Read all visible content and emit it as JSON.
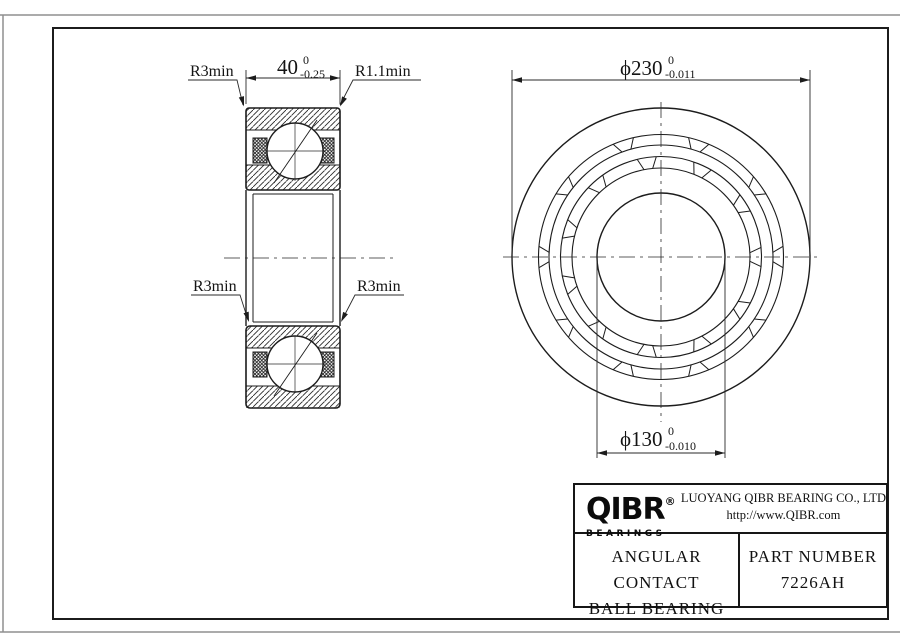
{
  "drawing_labels": {
    "dim_width": {
      "value": "40",
      "tol_upper": "0",
      "tol_lower": "-0.25"
    },
    "dim_od": {
      "value": "ϕ230",
      "tol_upper": "0",
      "tol_lower": "-0.011"
    },
    "dim_bore": {
      "value": "ϕ130",
      "tol_upper": "0",
      "tol_lower": "-0.010"
    },
    "r_top_left": "R3min",
    "r_top_right": "R1.1min",
    "r_mid_left": "R3min",
    "r_mid_right": "R3min"
  },
  "title_block": {
    "logo_text": "QIBR",
    "logo_registered": "®",
    "logo_subtext": "BEARINGS",
    "company_name": "LUOYANG QIBR BEARING CO., LTD",
    "website": "http://www.QIBR.com",
    "product_line1": "ANGULAR CONTACT",
    "product_line2": "BALL BEARING",
    "part_number_label": "PART NUMBER",
    "part_number": "7226AH"
  },
  "colors": {
    "line": "#1c1c1c",
    "thin_line": "#2a2a2a",
    "frame_outer": "#8f8f8f",
    "background": "#ffffff"
  }
}
